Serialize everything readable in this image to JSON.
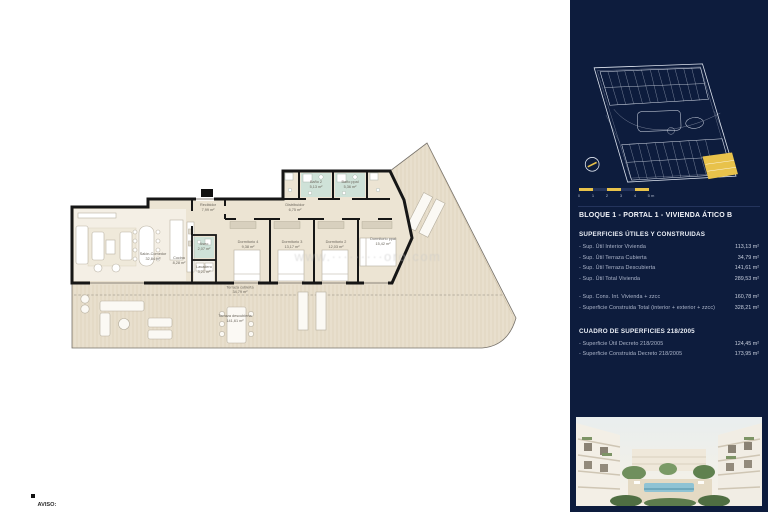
{
  "sidebar": {
    "title": "BLOQUE 1 - PORTAL 1 - VIVIENDA ÁTICO B",
    "sections": [
      {
        "title": "SUPERFICIES ÚTILES Y CONSTRUIDAS",
        "rows": [
          {
            "label": "-  Sup. Útil Interior Vivienda",
            "value": "113,13 m²"
          },
          {
            "label": "-  Sup. Útil Terraza Cubierta",
            "value": "34,79 m²"
          },
          {
            "label": "-  Sup. Útil Terraza Descubierta",
            "value": "141,61 m²"
          },
          {
            "label": "-  Sup. Útil Total Vivienda",
            "value": "289,53 m²"
          },
          {
            "label": "-  Sup. Cons. Int. Vivienda + zzcc",
            "value": "160,78 m²"
          },
          {
            "label": "-  Superficie Construida Total (interior + exterior + zzcc)",
            "value": "328,21 m²"
          }
        ]
      },
      {
        "title": "CUADRO DE SUPERFICIES 218/2005",
        "rows": [
          {
            "label": "-  Superficie Útil Decreto 218/2005",
            "value": "124,45 m²"
          },
          {
            "label": "-  Superficie Construida Decreto 218/2005",
            "value": "173,95 m²"
          }
        ]
      }
    ],
    "scalebar": {
      "ticks": [
        "0",
        "1",
        "2",
        "3",
        "4",
        "5 m"
      ]
    }
  },
  "plan": {
    "rooms": [
      {
        "name": "Salón-Comedor",
        "area": "32,84 m²"
      },
      {
        "name": "Cocina",
        "area": "8,28 m²"
      },
      {
        "name": "Recibidor",
        "area": "7,99 m²"
      },
      {
        "name": "Aseo",
        "area": "2,07 m²"
      },
      {
        "name": "Lavadero",
        "area": "3,21 m²"
      },
      {
        "name": "Distribuidor",
        "area": "6,75 m²"
      },
      {
        "name": "Dormitorio 4",
        "area": "9,38 m²"
      },
      {
        "name": "Dormitorio 3",
        "area": "13,17 m²"
      },
      {
        "name": "Dormitorio 2",
        "area": "12,03 m²"
      },
      {
        "name": "Dormitorio ppal",
        "area": "15,42 m²"
      },
      {
        "name": "Baño 2",
        "area": "5,13 m²"
      },
      {
        "name": "Baño ppal",
        "area": "5,36 m²"
      }
    ],
    "terrace": {
      "covered": {
        "name": "Terraza cubierta",
        "area": "34,79 m²"
      },
      "uncovered": {
        "name": "Terraza descubierta",
        "area": "141,61 m²"
      }
    },
    "watermark": "www.·········oro.com"
  },
  "footer": {
    "title": "AVISO:",
    "text": "El presente documento es de carácter informativo, no contractual. Las superficies referidas en este plano son orientativas y pueden sufrir variaciones por razones técnicas, legales o de ejecución."
  },
  "colors": {
    "sidebar_navy": "#0d1c3d",
    "accent_yellow": "#e8c24b",
    "terrace_beige": "#e8dfcd",
    "wet_room_green": "#cfe2d8"
  }
}
